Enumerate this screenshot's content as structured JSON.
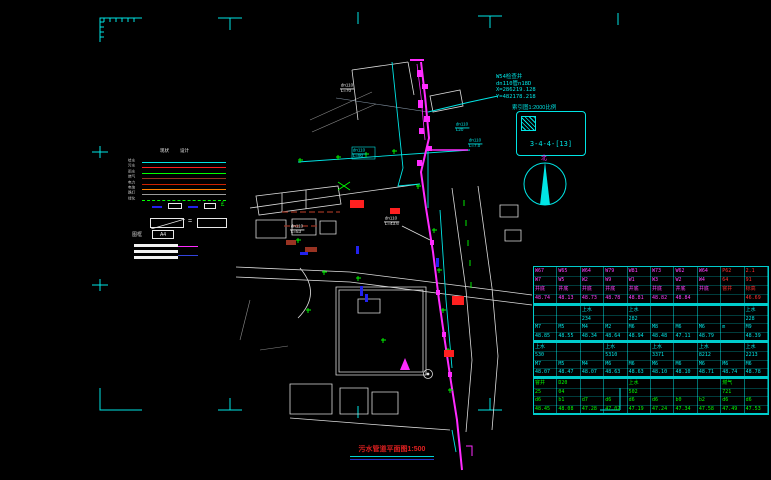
{
  "colors": {
    "background": "#000000",
    "cyan": "#00e5e5",
    "magenta": "#ff2bff",
    "green": "#00ff00",
    "red": "#ff2020",
    "white": "#ffffff",
    "blue": "#2222ee",
    "maroon": "#993322",
    "orange": "#ff8000",
    "gray": "#9a9a9a",
    "table_border": "#00cccc",
    "title_red": "#e02020"
  },
  "title": {
    "text": "污水管道平面图1:500"
  },
  "north": {
    "label": "北"
  },
  "index_box": {
    "caption": "索引图1:2000比例",
    "label": "3-4-4-[13]"
  },
  "coord_note": {
    "lines": [
      "W54检查井",
      "dn110管n18D",
      "X=286219.128",
      "Y=482178.218"
    ]
  },
  "legend": {
    "headers": [
      "现状",
      "设计"
    ],
    "rows": [
      {
        "label": "给水",
        "color": "#00e5e5",
        "style": "solid"
      },
      {
        "label": "污水",
        "color": "#ff2020",
        "style": "solid"
      },
      {
        "label": "雨水",
        "color": "#00ff00",
        "style": "solid"
      },
      {
        "label": "燃气",
        "color": "#993322",
        "style": "solid"
      },
      {
        "label": "电力",
        "color": "#cc2200",
        "style": "solid"
      },
      {
        "label": "电信",
        "color": "#ff8000",
        "style": "solid"
      },
      {
        "label": "路灯",
        "color": "#9a9a9a",
        "style": "solid"
      },
      {
        "label": "绿化",
        "color": "#00ff00",
        "style": "dashed"
      }
    ],
    "frame_label": "图框",
    "frame_size": "A4"
  },
  "pipe_labels": [
    {
      "line1": "dn110",
      "line2": "L=70",
      "x": 340,
      "y": 84,
      "color": "#e8e8e8"
    },
    {
      "line1": "dn110",
      "line2": "L=90",
      "x": 352,
      "y": 149,
      "color": "#00e5e5"
    },
    {
      "line1": "dn110",
      "line2": "L20",
      "x": 455,
      "y": 123,
      "color": "#00e5e5"
    },
    {
      "line1": "dn110",
      "line2": "L=7.0",
      "x": 468,
      "y": 139,
      "color": "#00e5e5"
    },
    {
      "line1": "dn110",
      "line2": "L=43.6",
      "x": 384,
      "y": 217,
      "color": "#e8e8e8"
    },
    {
      "line1": "dn110",
      "line2": "L=53",
      "x": 290,
      "y": 225,
      "color": "#e8e8e8"
    }
  ],
  "table": {
    "groups": [
      {
        "color": "#ff40ff",
        "alt_color": "#ff3030",
        "alt_from": 8,
        "h": 39,
        "rows": [
          [
            "W67",
            "W65",
            "W64",
            "W79",
            "W81",
            "W73",
            "W62",
            "W64",
            "P62",
            "2.1"
          ],
          [
            "W7",
            "W5",
            "W2",
            "W9",
            "W1",
            "W3",
            "W2",
            "W4",
            "64",
            "91"
          ],
          [
            "井底",
            "井底",
            "井底",
            "井底",
            "井底",
            "井底",
            "井底",
            "井底",
            "窨井",
            "标高"
          ],
          [
            "48.74",
            "48.13",
            "48.73",
            "48.78",
            "48.81",
            "48.82",
            "48.84",
            "",
            "",
            "46.69"
          ]
        ]
      },
      {
        "color": "#00e5e5",
        "h": 37,
        "rows": [
          [
            "",
            "",
            "上水",
            "",
            "上水",
            "",
            "",
            "",
            "",
            "上水"
          ],
          [
            "",
            "",
            "234",
            "",
            "282",
            "",
            "",
            "",
            "",
            "228"
          ],
          [
            "M7",
            "M5",
            "M4",
            "M2",
            "M6",
            "M8",
            "M6",
            "M6",
            "m",
            "M9"
          ],
          [
            "48.85",
            "48.55",
            "48.34",
            "48.64",
            "48.94",
            "48.48",
            "47.11",
            "48.79",
            "",
            "48.39"
          ]
        ]
      },
      {
        "color": "#00e5e5",
        "h": 36,
        "rows": [
          [
            "上水",
            "",
            "",
            "上水",
            "",
            "上水",
            "",
            "上水",
            "",
            "上水"
          ],
          [
            "530",
            "",
            "",
            "5310",
            "",
            "3371",
            "",
            "8212",
            "",
            "2213"
          ],
          [
            "M7",
            "M5",
            "M4",
            "M6",
            "M6",
            "M6",
            "M6",
            "M6",
            "M6",
            "M6"
          ],
          [
            "48.07",
            "48.47",
            "48.07",
            "48.63",
            "48.63",
            "48.10",
            "48.10",
            "48.71",
            "48.74",
            "48.78"
          ]
        ]
      },
      {
        "color": "#00ff00",
        "h": 37,
        "rows": [
          [
            "窨井",
            "D20",
            "",
            "",
            "上水",
            "",
            "",
            "",
            "燃气",
            ""
          ],
          [
            "25",
            "04",
            "",
            "",
            "502",
            "",
            "",
            "",
            "721",
            ""
          ],
          [
            "d6",
            "b1",
            "d7",
            "d6",
            "d6",
            "d6",
            "b0",
            "b2",
            "d6",
            "d6"
          ],
          [
            "48.45",
            "48.08",
            "47.28",
            "47.02",
            "47.19",
            "47.24",
            "47.34",
            "47.58",
            "47.49",
            "47.53"
          ]
        ]
      }
    ]
  }
}
